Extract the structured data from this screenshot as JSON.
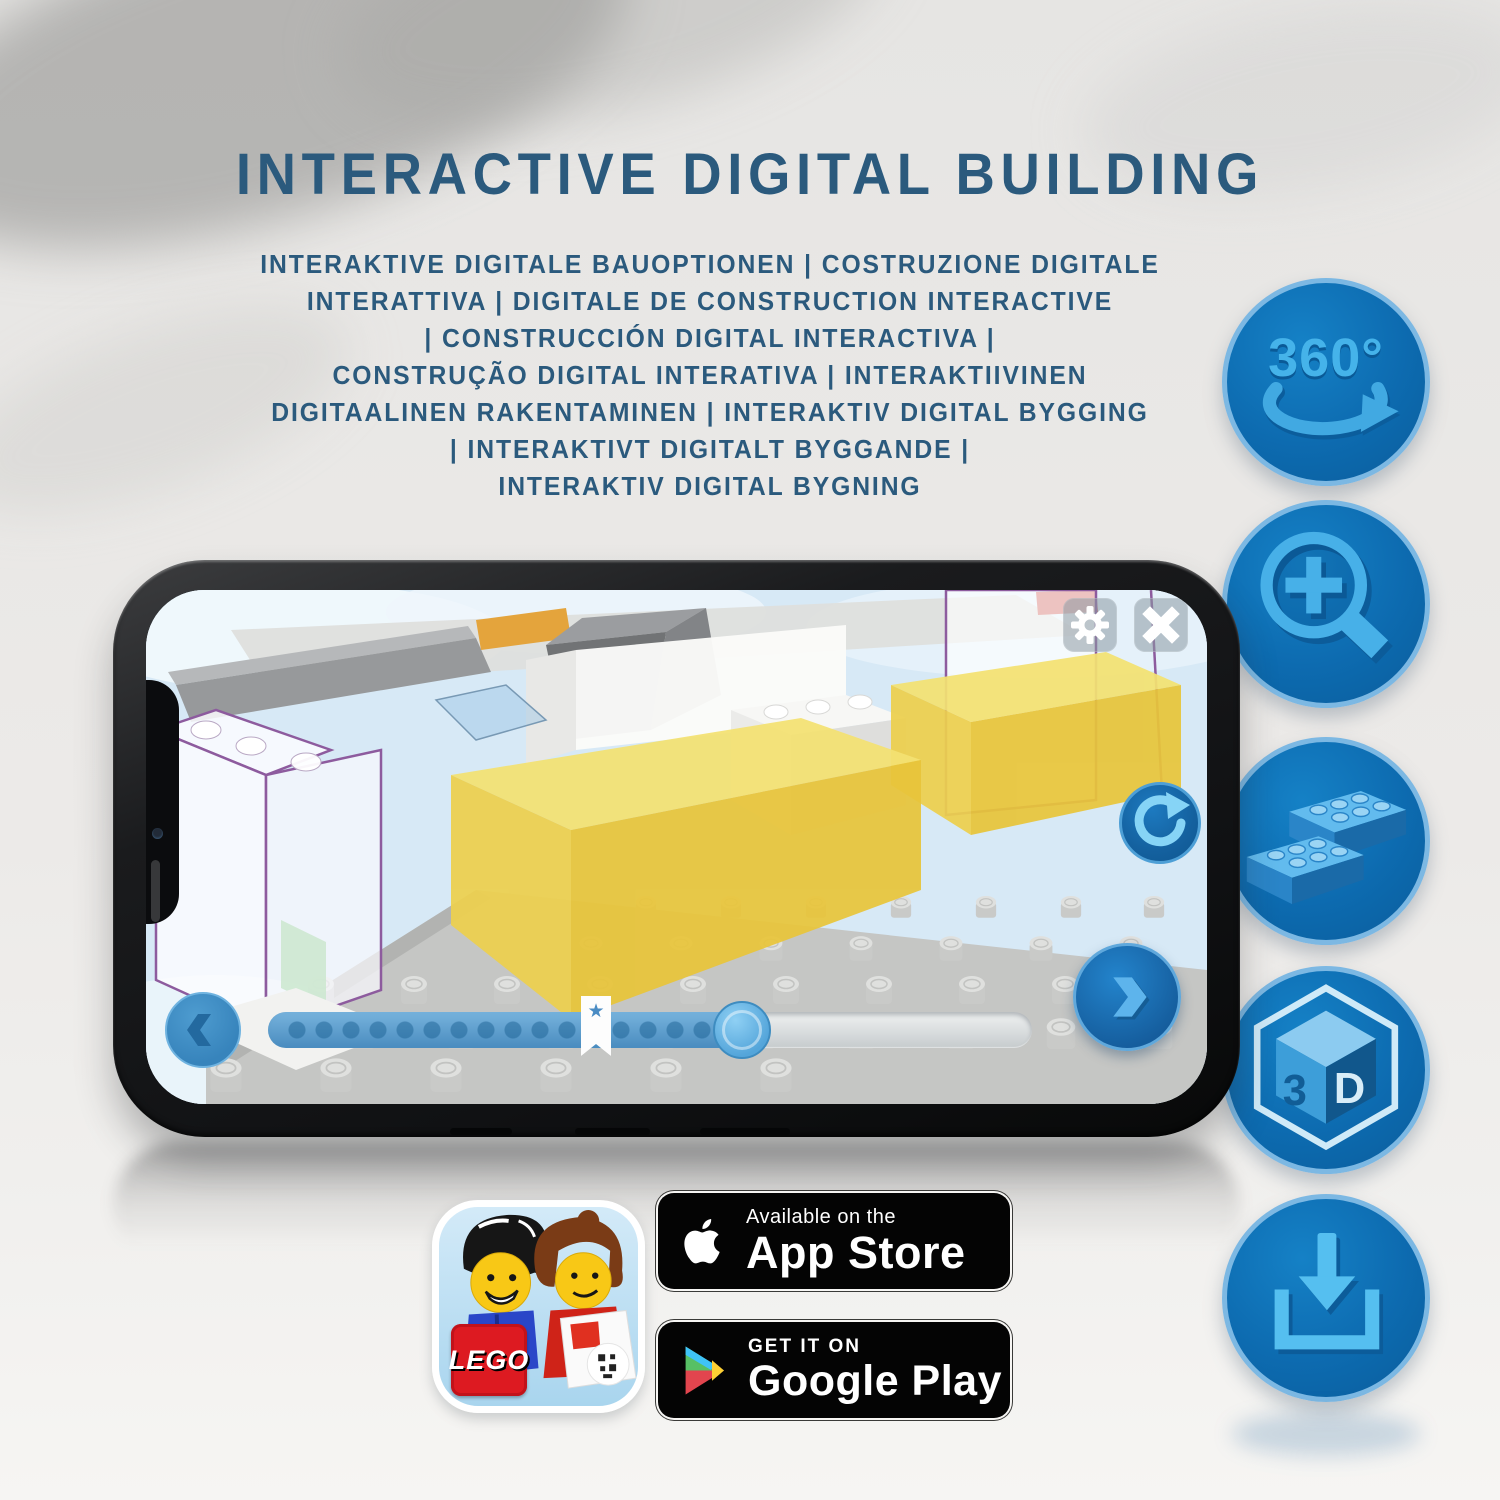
{
  "header": {
    "title": "INTERACTIVE DIGITAL BUILDING"
  },
  "subtitle_lines": [
    "INTERAKTIVE DIGITALE BAUOPTIONEN | COSTRUZIONE DIGITALE",
    "INTERATTIVA | DIGITALE DE CONSTRUCTION INTERACTIVE",
    "| CONSTRUCCIÓN DIGITAL INTERACTIVA |",
    "CONSTRUÇÃO DIGITAL INTERATIVA | INTERAKTIIVINEN",
    "DIGITAALINEN RAKENTAMINEN | INTERAKTIV DIGITAL BYGGING",
    "| INTERAKTIVT DIGITALT BYGGANDE |",
    "INTERAKTIV DIGITAL BYGNING"
  ],
  "feature_badges": {
    "rotate_360_label": "360°",
    "cube_left": "3",
    "cube_right": "D"
  },
  "phone_ui": {
    "progress_percent": 62,
    "icons": {
      "star": "★"
    }
  },
  "store": {
    "app_store": {
      "line1": "Available on the",
      "line2": "App Store"
    },
    "google_play": {
      "line1": "GET IT ON",
      "line2": "Google Play"
    }
  },
  "app_icon": {
    "lego_text": "LEGO"
  },
  "colors": {
    "heading": "#2b5a7d",
    "feature_circle": "#0d6bb0",
    "feature_glyph": "#45b3ea",
    "app_blue": "#1b74b8",
    "slider_fill": "#5ba3d4",
    "yellow_brick": "#eed34f",
    "purple_outline": "#8d5b9e"
  }
}
